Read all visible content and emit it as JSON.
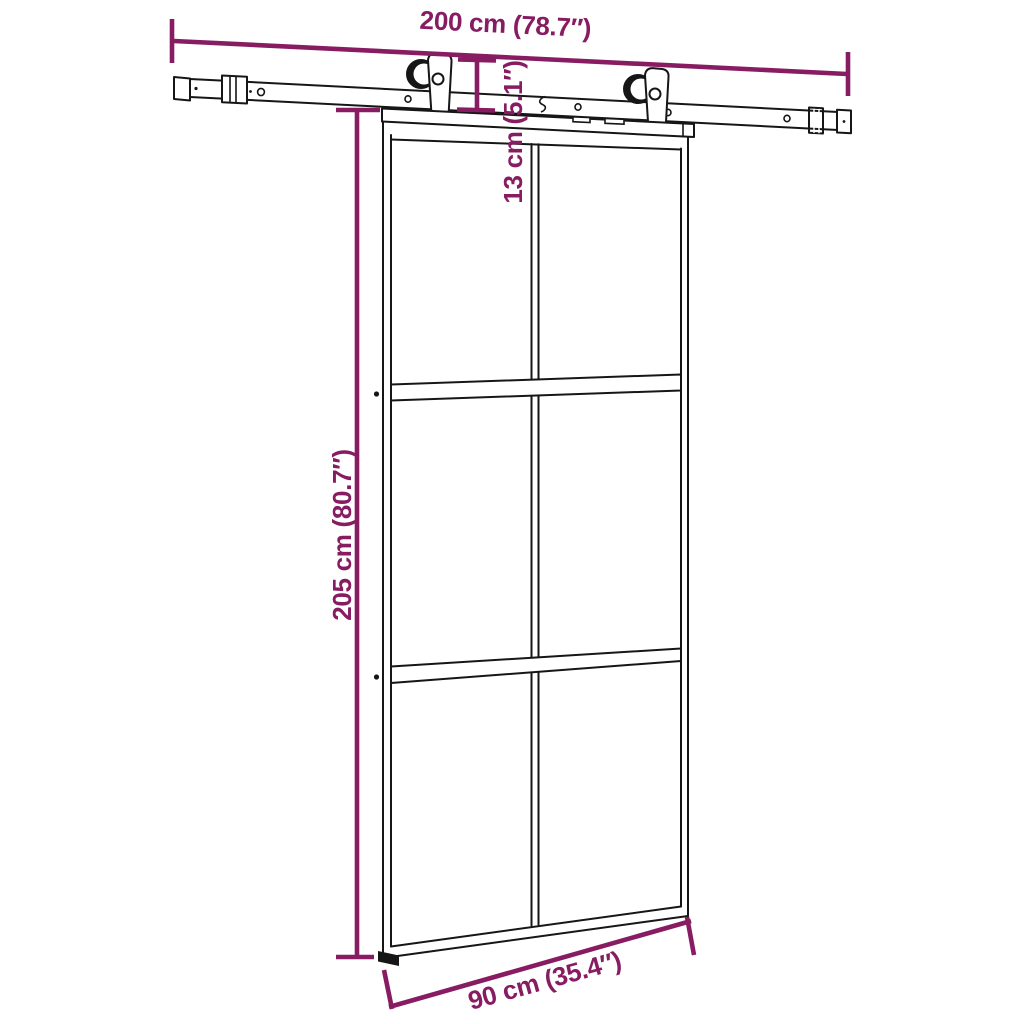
{
  "diagram_title": "sliding-door-with-hardware-set-dimension-diagram",
  "colors": {
    "dimension": "#871c62",
    "line": "#161616",
    "background": "#ffffff"
  },
  "dimensions": {
    "track_width_label": "200 cm (78.7″)",
    "hanger_drop_label": "13 cm (5.1″)",
    "door_height_label": "205 cm (80.7″)",
    "door_width_label": "90 cm (35.4″)"
  },
  "structure": {
    "glass_panels": 6,
    "rollers": 2,
    "panel_grid": "2 columns × 3 rows"
  }
}
